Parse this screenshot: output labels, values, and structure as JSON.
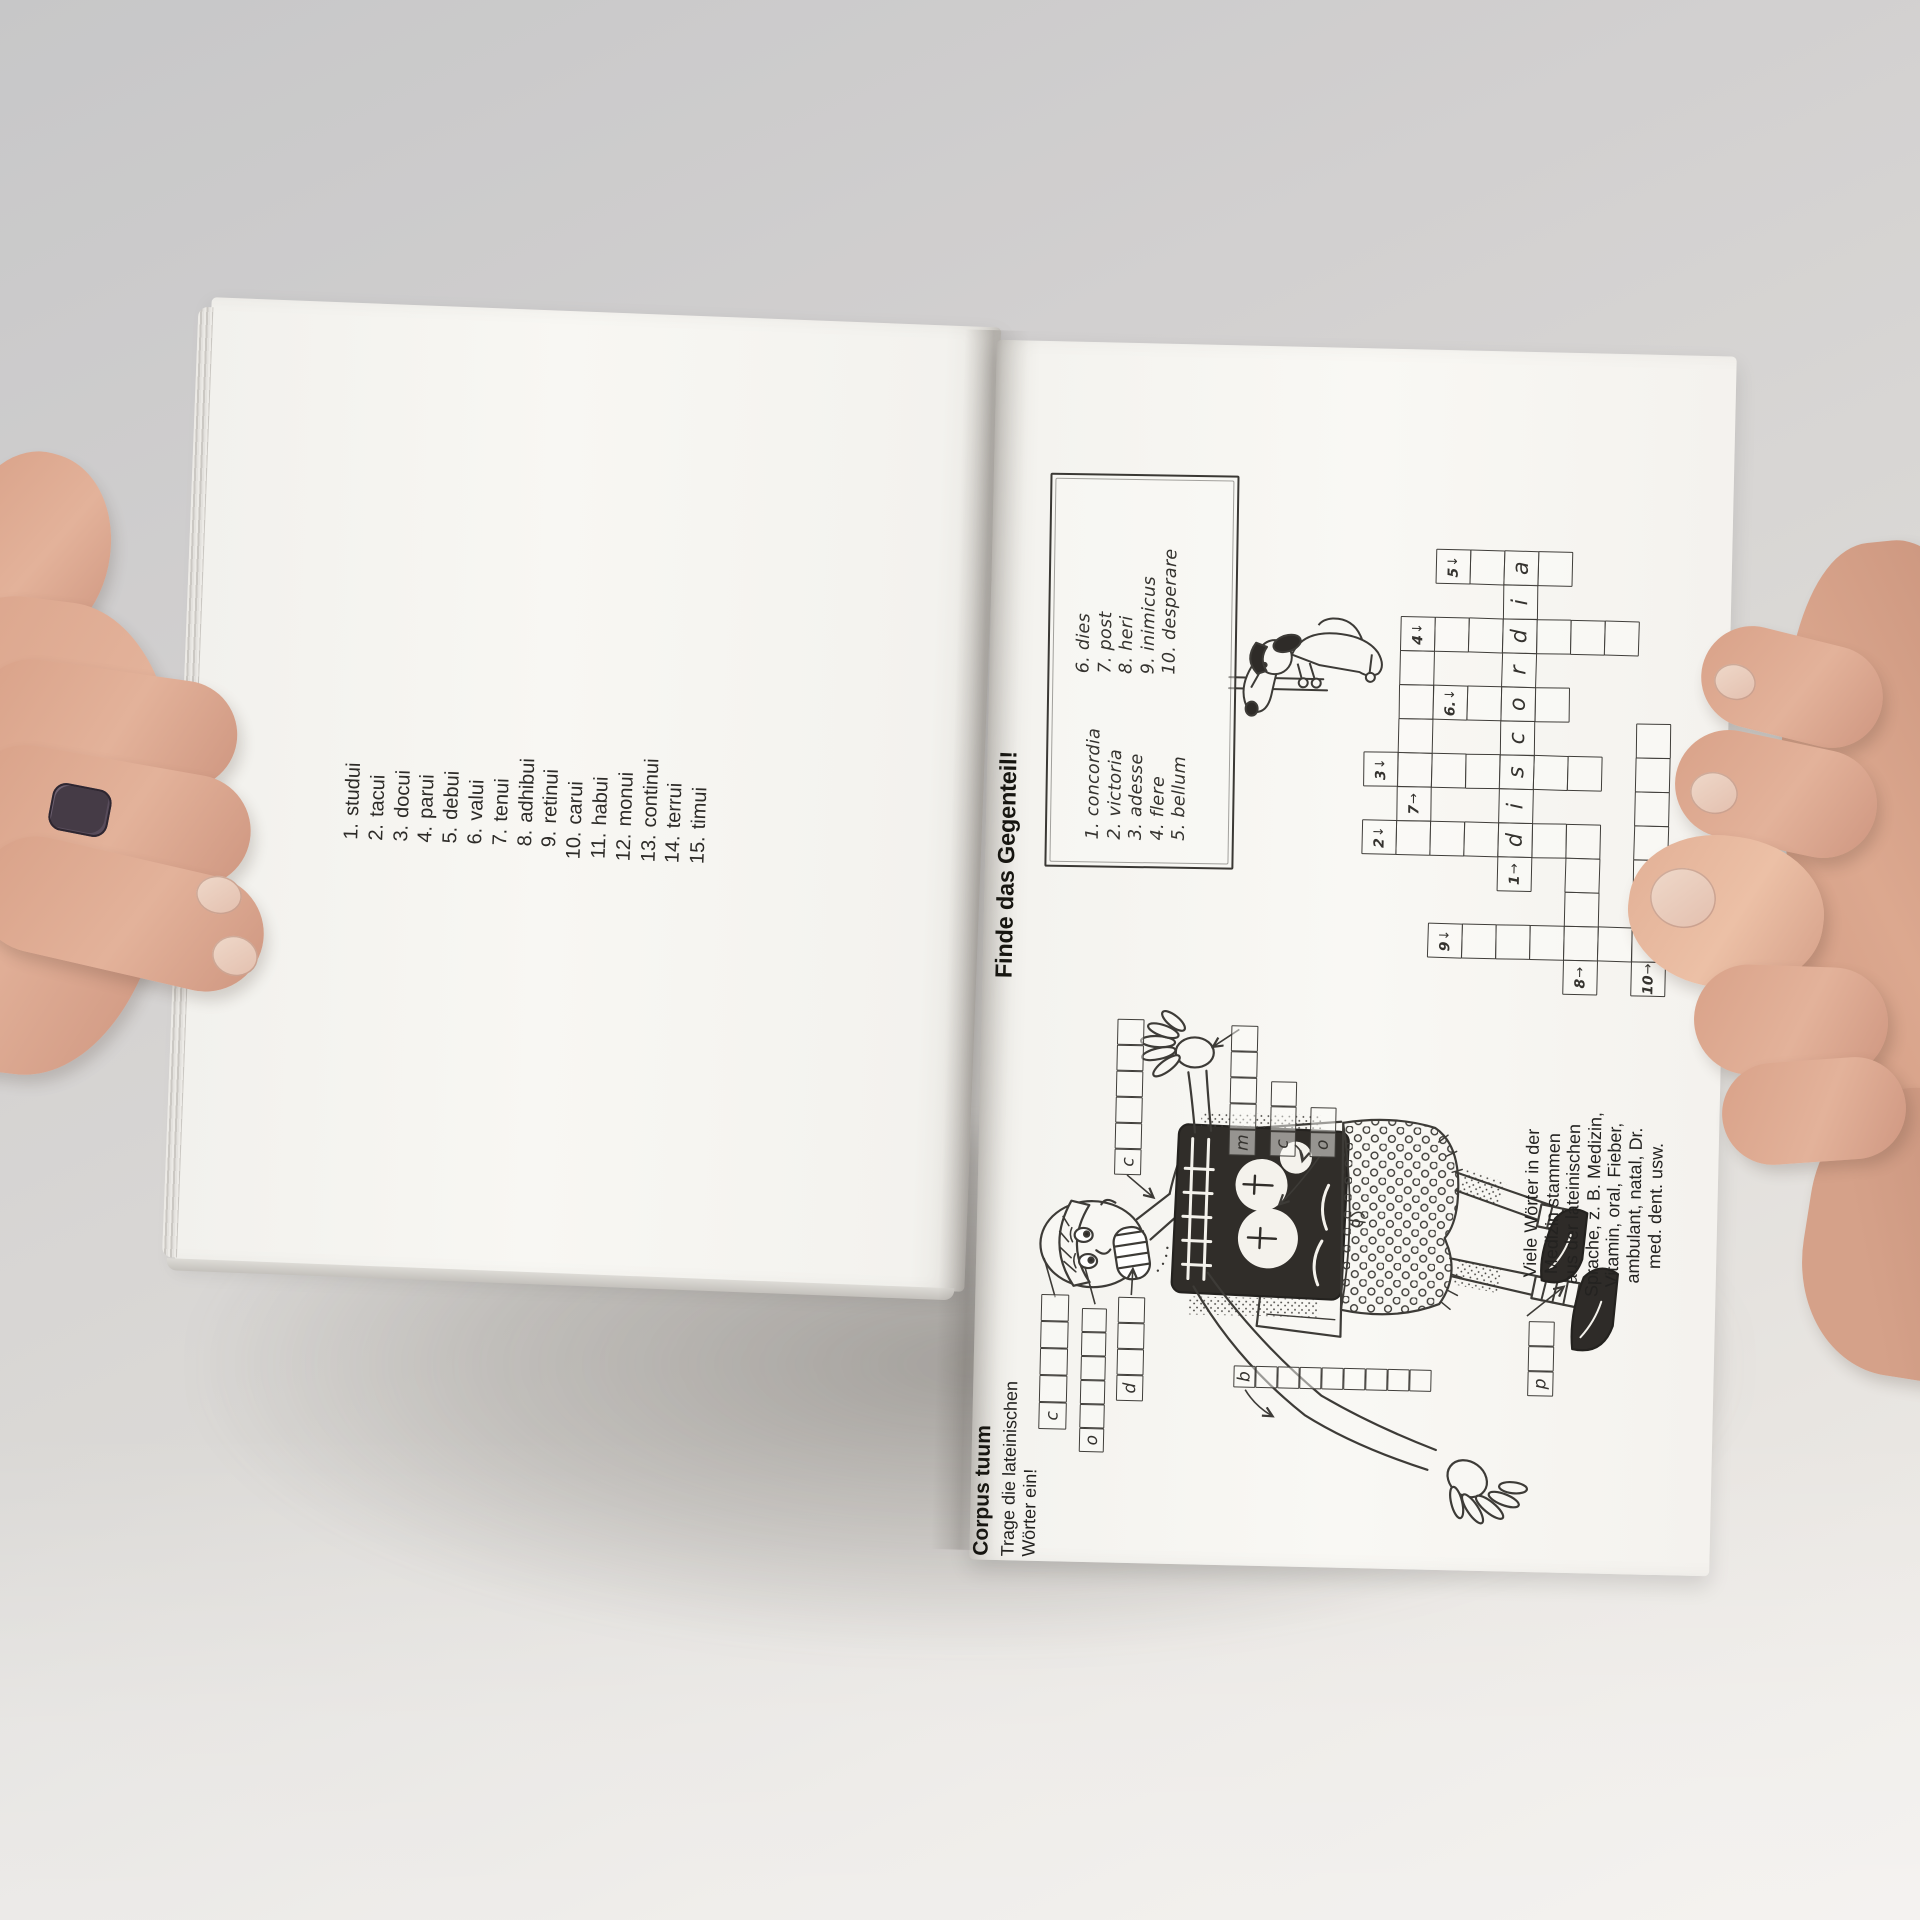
{
  "left_page": {
    "exercise_list": [
      {
        "num": "1.",
        "word": "studui"
      },
      {
        "num": "2.",
        "word": "tacui"
      },
      {
        "num": "3.",
        "word": "docui"
      },
      {
        "num": "4.",
        "word": "parui"
      },
      {
        "num": "5.",
        "word": "debui"
      },
      {
        "num": "6.",
        "word": "valui"
      },
      {
        "num": "7.",
        "word": "tenui"
      },
      {
        "num": "8.",
        "word": "adhibui"
      },
      {
        "num": "9.",
        "word": "retinui"
      },
      {
        "num": "10.",
        "word": "carui"
      },
      {
        "num": "11.",
        "word": "habui"
      },
      {
        "num": "12.",
        "word": "monui"
      },
      {
        "num": "13.",
        "word": "continui"
      },
      {
        "num": "14.",
        "word": "terrui"
      },
      {
        "num": "15.",
        "word": "timui"
      }
    ]
  },
  "right_page": {
    "gegenteil": {
      "heading": "Finde das Gegenteil!",
      "sign": {
        "left_column": [
          "1. concordia",
          "2. victoria",
          "3. adesse",
          "4. flere",
          "5. bellum"
        ],
        "right_column": [
          "6. dies",
          "7. post",
          "8. heri",
          "9. inimicus",
          "10. desperare"
        ]
      },
      "crossword": {
        "origin_x": 578,
        "origin_y": 342,
        "cell": 34,
        "filled_answer": "discordia",
        "labels": [
          {
            "num": "1",
            "arrow": "→",
            "col": 3,
            "row": 5
          },
          {
            "num": "2",
            "arrow": "↓",
            "col": 4,
            "row": 1
          },
          {
            "num": "3",
            "arrow": "↓",
            "col": 6,
            "row": 1
          },
          {
            "num": "4",
            "arrow": "↓",
            "col": 10,
            "row": 2
          },
          {
            "num": "5",
            "arrow": "↓",
            "col": 12,
            "row": 3
          },
          {
            "num": "6.",
            "arrow": "↓",
            "col": 8,
            "row": 3
          },
          {
            "num": "7",
            "arrow": "→",
            "col": 5,
            "row": 2
          },
          {
            "num": "8",
            "arrow": "→",
            "col": 0,
            "row": 7
          },
          {
            "num": "9",
            "arrow": "↓",
            "col": 1,
            "row": 3
          },
          {
            "num": "10",
            "arrow": "→",
            "col": 0,
            "row": 9
          }
        ],
        "letter_cells": [
          {
            "ch": "d",
            "col": 4,
            "row": 5
          },
          {
            "ch": "i",
            "col": 5,
            "row": 5
          },
          {
            "ch": "s",
            "col": 6,
            "row": 5
          },
          {
            "ch": "c",
            "col": 7,
            "row": 5
          },
          {
            "ch": "o",
            "col": 8,
            "row": 5
          },
          {
            "ch": "r",
            "col": 9,
            "row": 5
          },
          {
            "ch": "d",
            "col": 10,
            "row": 5
          },
          {
            "ch": "i",
            "col": 11,
            "row": 5
          },
          {
            "ch": "a",
            "col": 12,
            "row": 5
          }
        ],
        "empty_cells": [
          [
            4,
            2
          ],
          [
            4,
            3
          ],
          [
            4,
            4
          ],
          [
            4,
            6
          ],
          [
            4,
            7
          ],
          [
            6,
            2
          ],
          [
            6,
            3
          ],
          [
            6,
            4
          ],
          [
            6,
            6
          ],
          [
            6,
            7
          ],
          [
            7,
            2
          ],
          [
            8,
            2
          ],
          [
            9,
            2
          ],
          [
            10,
            3
          ],
          [
            10,
            4
          ],
          [
            10,
            6
          ],
          [
            10,
            7
          ],
          [
            10,
            8
          ],
          [
            8,
            4
          ],
          [
            8,
            6
          ],
          [
            12,
            4
          ],
          [
            12,
            6
          ],
          [
            1,
            4
          ],
          [
            1,
            5
          ],
          [
            1,
            6
          ],
          [
            1,
            7
          ],
          [
            1,
            8
          ],
          [
            1,
            9
          ],
          [
            2,
            7
          ],
          [
            3,
            7
          ],
          [
            2,
            9
          ],
          [
            3,
            9
          ],
          [
            4,
            9
          ],
          [
            5,
            9
          ],
          [
            6,
            9
          ],
          [
            7,
            9
          ]
        ]
      }
    },
    "corpus": {
      "heading": "Corpus tuum",
      "subtitle_lines": [
        "Trage die lateinischen",
        "Wörter ein!"
      ],
      "strips": [
        {
          "id": "caput",
          "letter": "c",
          "cells": 5,
          "dir": "h",
          "x": 132,
          "y": 66,
          "size": 27
        },
        {
          "id": "oculus",
          "letter": "o",
          "cells": 6,
          "dir": "h",
          "x": 110,
          "y": 107,
          "size": 24
        },
        {
          "id": "dens",
          "letter": "d",
          "cells": 4,
          "dir": "h",
          "x": 162,
          "y": 143,
          "size": 26
        },
        {
          "id": "collum",
          "letter": "c",
          "cells": 6,
          "dir": "h",
          "x": 388,
          "y": 136,
          "size": 26
        },
        {
          "id": "manus",
          "letter": "m",
          "cells": 5,
          "dir": "h",
          "x": 410,
          "y": 250,
          "size": 26
        },
        {
          "id": "cor",
          "letter": "c",
          "cells": 3,
          "dir": "h",
          "x": 410,
          "y": 291,
          "size": 25
        },
        {
          "id": "os",
          "letter": "o",
          "cells": 2,
          "dir": "h",
          "x": 410,
          "y": 331,
          "size": 25
        },
        {
          "id": "bracchium",
          "letter": "b",
          "cells": 9,
          "dir": "v",
          "x": 178,
          "y": 260,
          "size": 22
        },
        {
          "id": "pes",
          "letter": "p",
          "cells": 3,
          "dir": "h",
          "x": 176,
          "y": 554,
          "size": 25
        }
      ],
      "note_lines": [
        "Viele Wörter in der",
        "Medizin stammen",
        "aus der lateinischen",
        "Sprache, z. B. Medizin,",
        "Vitamin, oral, Fieber,",
        "ambulant, natal, Dr.",
        "med. dent. usw."
      ]
    }
  }
}
